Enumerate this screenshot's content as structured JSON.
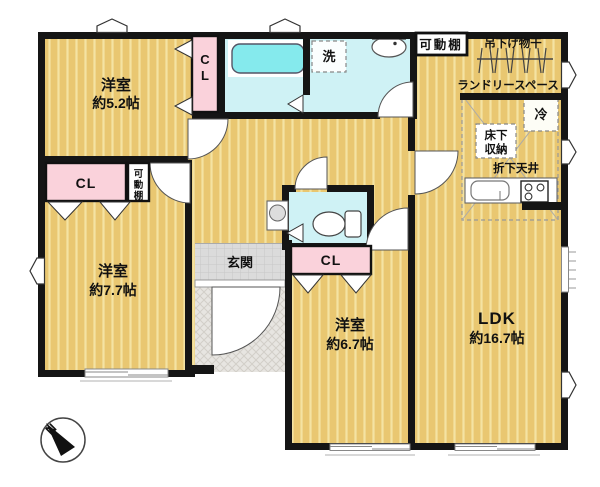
{
  "floorplan": {
    "rooms": {
      "bedroom_52": {
        "name": "洋室",
        "size": "約5.2帖"
      },
      "bedroom_77": {
        "name": "洋室",
        "size": "約7.7帖"
      },
      "bedroom_67": {
        "name": "洋室",
        "size": "約6.7帖"
      },
      "ldk": {
        "name": "LDK",
        "size": "約16.7帖"
      },
      "entrance": {
        "name": "玄関"
      }
    },
    "closets": {
      "cl_52_vertical": {
        "line1": "C",
        "line2": "L"
      },
      "cl_77": "CL",
      "cl_67": "CL"
    },
    "fixtures": {
      "movable_shelf_top": "可動棚",
      "movable_shelf_77": {
        "line1": "可",
        "line2": "動",
        "line3": "棚"
      },
      "washer": "洗",
      "hanging_rod": "吊下げ物干",
      "laundry_space": "ランドリースペース",
      "refrigerator": "冷",
      "underfloor_storage": {
        "line1": "床下",
        "line2": "収納"
      },
      "lowered_ceiling": "折下天井"
    },
    "compass": {
      "north": "N"
    },
    "colors": {
      "floor_tan": "#E9C771",
      "floor_stripe": "#F4E3A3",
      "closet_pink": "#FAD2DB",
      "wet_area_cyan": "#CFF2F5",
      "bathtub_cyan": "#85EAED",
      "wall": "#151515",
      "hall_gray": "#DBDBDB",
      "doma_gray": "#E7E5E1"
    }
  }
}
